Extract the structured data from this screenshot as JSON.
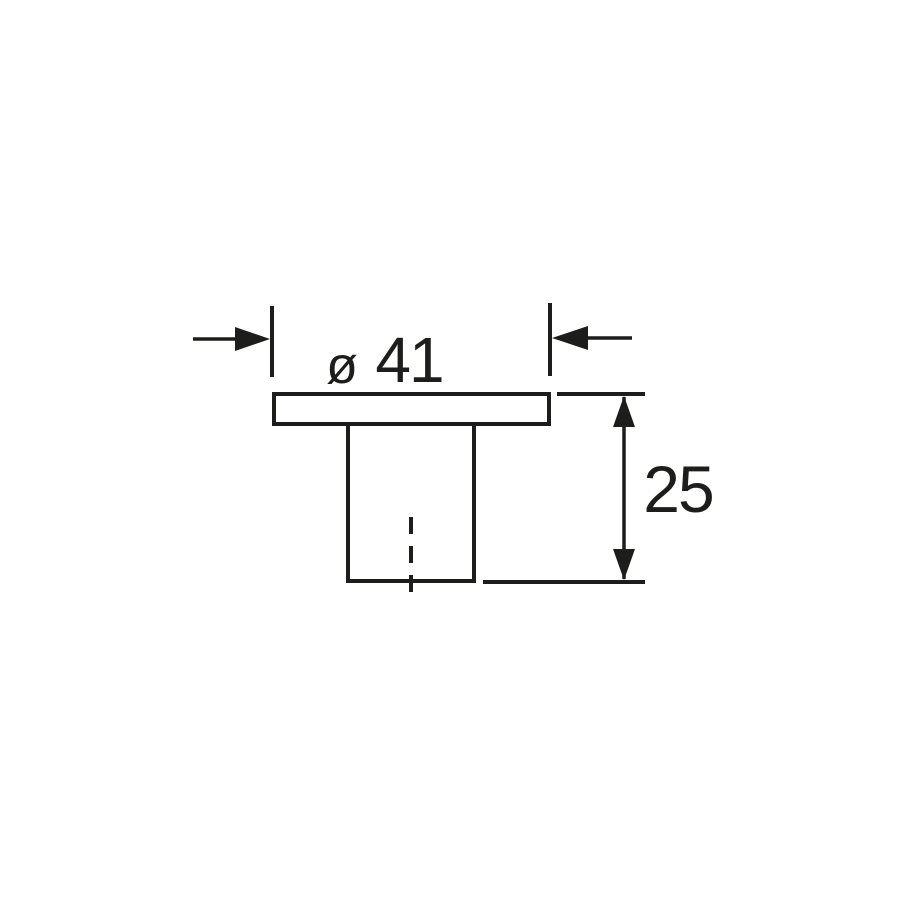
{
  "page": {
    "background_color": "#ffffff"
  },
  "drawing": {
    "line_color": "#1d1d1b",
    "fill_color": "#ffffff",
    "dimensions": {
      "diameter": {
        "symbol": "ø",
        "value": "41"
      },
      "height": {
        "value": "25"
      }
    }
  }
}
